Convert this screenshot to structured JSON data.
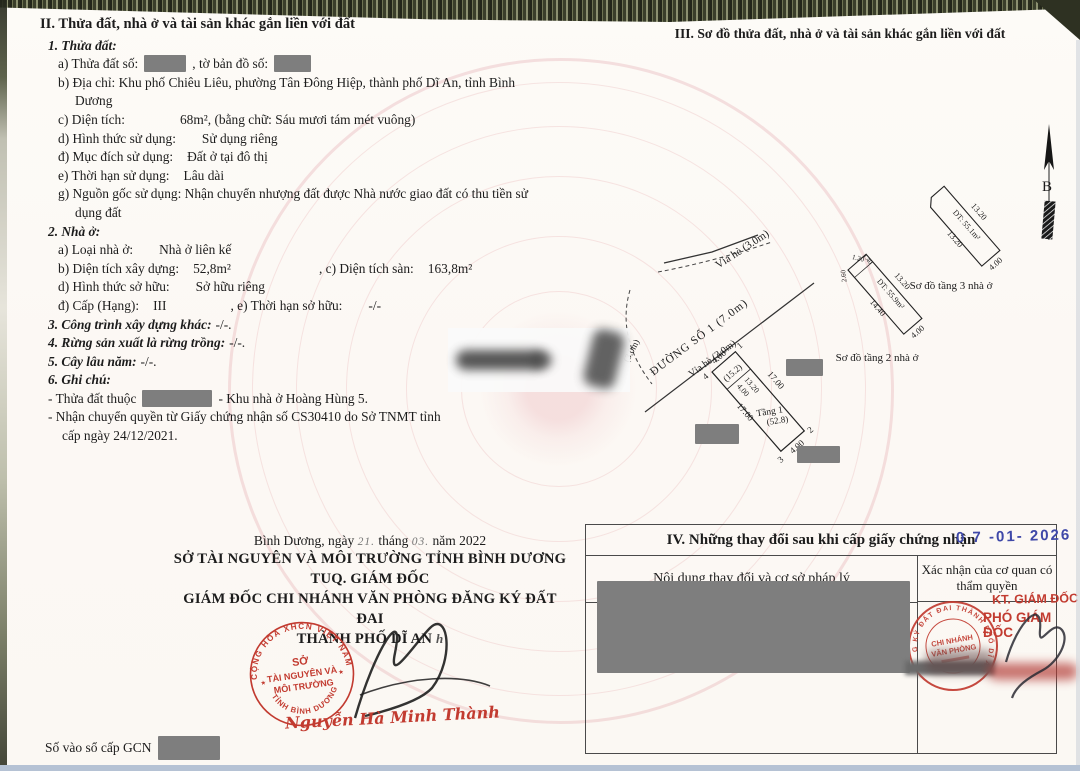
{
  "doc": {
    "footer_label": "Số vào sổ cấp GCN"
  },
  "s2": {
    "title": "II. Thửa đất, nhà ở và tài sản khác gắn liền với đất",
    "h1": "1. Thửa đất:",
    "a_l": "a) Thửa đất số:",
    "a_m": ", tờ bản đồ số:",
    "b": "b) Địa chỉ:  Khu phố Chiêu Liêu, phường Tân Đông Hiệp, thành phố Dĩ An, tỉnh Bình Dương",
    "c_l": "c) Diện tích:",
    "c_v": "68m², (bằng chữ: Sáu mươi tám mét vuông)",
    "d_l": "d) Hình thức sử dụng:",
    "d_v": "Sử dụng riêng",
    "dd_l": "đ) Mục đích sử dụng:",
    "dd_v": "Đất ở tại đô thị",
    "e_l": "e) Thời hạn sử dụng:",
    "e_v": "Lâu dài",
    "g_l": "g) Nguồn gốc sử dụng:",
    "g_v": "Nhận chuyển nhượng đất được Nhà nước giao đất có thu tiền sử dụng đất",
    "h2": "2. Nhà ở:",
    "a2_l": "a) Loại nhà ở:",
    "a2_v": "Nhà ở liên kế",
    "b2_l": "b) Diện tích xây dựng:",
    "b2_v": "52,8m²",
    "c2_l": ", c) Diện tích sàn:",
    "c2_v": "163,8m²",
    "d2_l": "d) Hình thức sở hữu:",
    "d2_v": "Sở hữu riêng",
    "dd2_l": "đ) Cấp (Hạng):",
    "dd2_v": "III",
    "e2_l": ", e) Thời hạn sở hữu:",
    "e2_v": "-/-",
    "h3": "3. Công trình xây dựng khác:",
    "h3_v": "-/-.",
    "h4": "4. Rừng sản xuất là rừng trồng:",
    "h4_v": "-/-.",
    "h5": "5. Cây lâu năm:",
    "h5_v": "-/-.",
    "h6": "6. Ghi chú:",
    "n1_a": "- Thửa đất thuộc",
    "n1_b": "- Khu nhà ở Hoàng Hùng 5.",
    "n2": "- Nhận chuyển quyền từ Giấy chứng nhận số CS30410 do Sở TNMT tỉnh",
    "n3": "cấp ngày 24/12/2021."
  },
  "s3": {
    "title": "III. Sơ đồ thửa đất, nhà ở và tài sản khác gắn liền với đất"
  },
  "diagram": {
    "north_label": "B",
    "sidewalk_top": "Vỉa hè (3.0m)",
    "road": "ĐƯỜNG SỐ 1 (7.0m)",
    "sidewalk_plot": "Vỉa hè (3.0m)",
    "sidewalk_small": "(3.0m)",
    "plot": {
      "c1": "1",
      "c2": "2",
      "c3": "3",
      "c4": "4",
      "top_dim": "4.00",
      "inner_note": "(15.2)",
      "inner_w": "4.00",
      "inner_l": "13.20",
      "left_dim": "17.00",
      "right_dim": "17.00",
      "bottom_dim": "4.00",
      "floor_label": "Tầng 1",
      "floor_area": "(52.8)"
    },
    "floor2": {
      "caption": "Sơ đồ tầng 2 nhà ở",
      "area": "DT: 55.9m²",
      "d1": "2.60",
      "d2": "1.20",
      "d3": "1.40",
      "right": "13.20",
      "left": "14.40",
      "bottom": "4.00"
    },
    "floor3": {
      "caption": "Sơ đồ tầng 3 nhà ở",
      "area": "DT: 55.1m²",
      "right": "13.20",
      "left": "13.20",
      "bottom": "4.00"
    }
  },
  "sig": {
    "place": "Bình Dương, ngày",
    "day": "21.",
    "thang": "tháng",
    "month": "03.",
    "year": "năm 2022",
    "org": "SỞ TÀI NGUYÊN VÀ MÔI TRƯỜNG TỈNH BÌNH DƯƠNG",
    "tuq": "TUQ. GIÁM ĐỐC",
    "dir": "GIÁM ĐỐC CHI NHÁNH VĂN PHÒNG ĐĂNG KÝ ĐẤT ĐAI",
    "city": "THÀNH PHỐ DĨ AN",
    "mark": "h",
    "signer": "Nguyễn Hà Minh Thành",
    "seal_top": "CỘNG HÒA XHCN VIỆT NAM",
    "seal_bottom": "TỈNH BÌNH DƯƠNG",
    "seal_l1": "SỞ",
    "seal_l2": "TÀI NGUYÊN VÀ",
    "seal_l3": "MÔI TRƯỜNG",
    "star": "★"
  },
  "t4": {
    "title": "IV. Những thay đổi sau khi cấp giấy chứng nhận",
    "col1": "Nội dung thay đổi và cơ sở pháp lý",
    "col2": "Xác nhận của cơ quan có thẩm quyền",
    "date_stamp": "0 7 -01- 2026",
    "kt": "KT. GIÁM ĐỐC",
    "pho": "PHÓ GIÁM ĐỐC",
    "stamp_ring": "VP ĐĂNG KÝ ĐẤT ĐAI THÀNH PHỐ DĨ AN",
    "stamp_l1": "CHI NHÁNH",
    "stamp_l2": "VĂN PHÒNG"
  },
  "colors": {
    "stamp_red": "#c23b30",
    "date_blue": "#3f48a8",
    "redact_grey": "#7e7e7e"
  }
}
